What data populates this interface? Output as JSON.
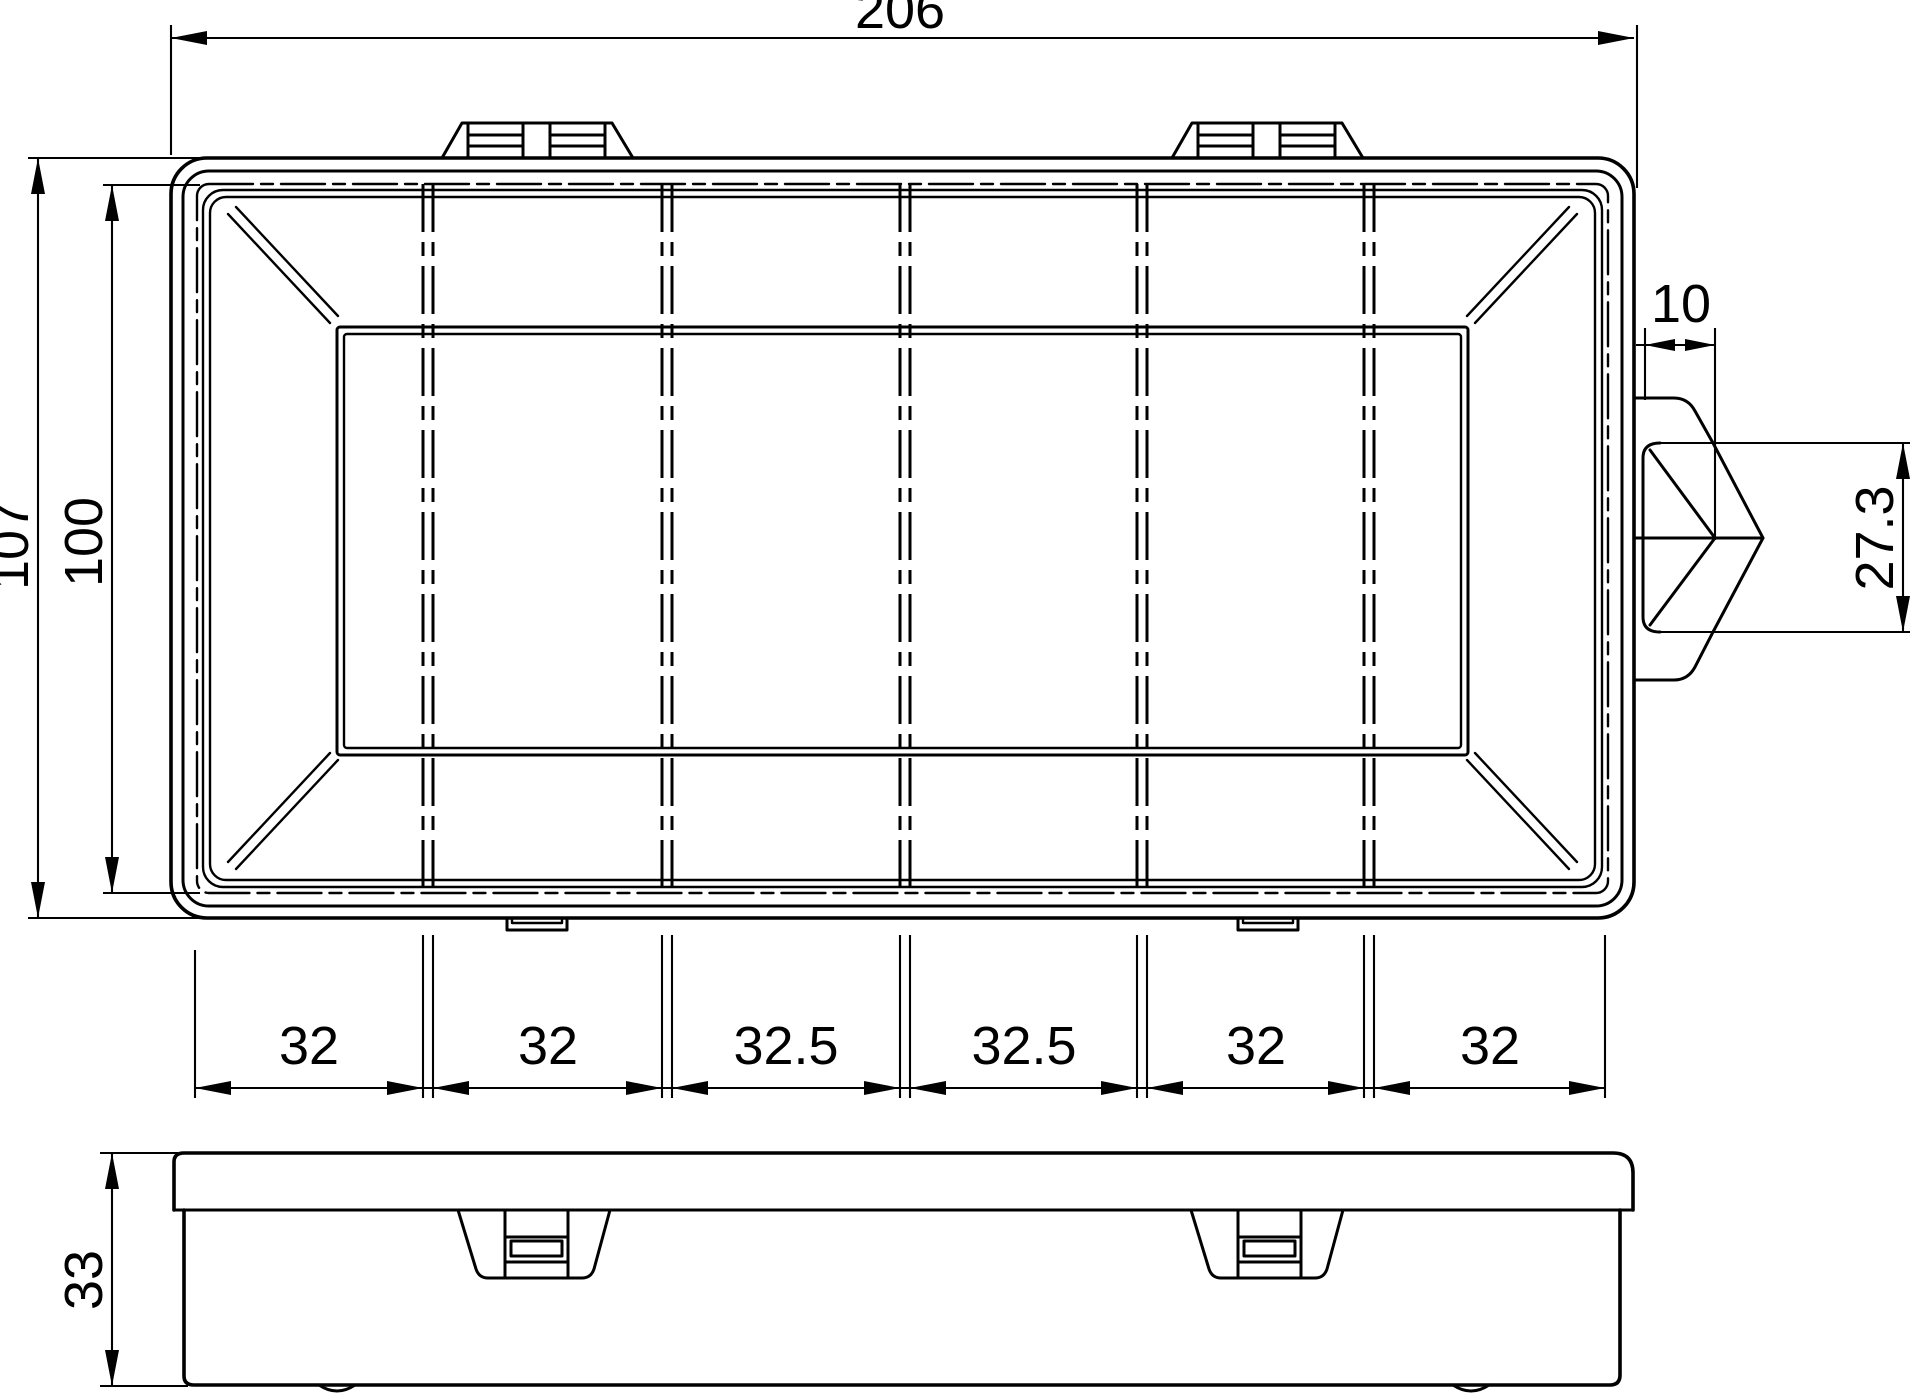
{
  "colors": {
    "line": "#000000",
    "background": "#ffffff"
  },
  "top_view": {
    "overall_width_label": "206",
    "overall_depth_label": "107",
    "inner_depth_label": "100",
    "latch_width_label": "10",
    "latch_height_label": "27.3",
    "compartment_labels": [
      "32",
      "32",
      "32.5",
      "32.5",
      "32",
      "32"
    ]
  },
  "side_view": {
    "height_label": "33"
  }
}
